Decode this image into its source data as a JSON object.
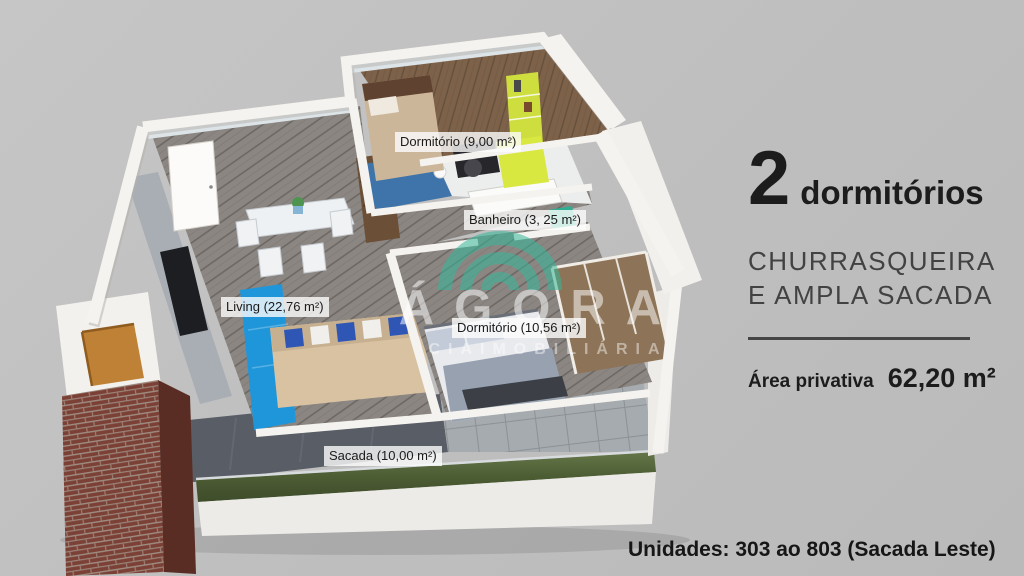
{
  "colors": {
    "background": "#bfbfbf",
    "watermark_teal": "#35b89a",
    "brick_red": "#7c4136",
    "glass_green": "#5a6b3c",
    "accent_blue": "#2096da",
    "accent_lime": "#cede3e"
  },
  "floorplan": {
    "rooms": [
      {
        "id": "dormitorio-1",
        "label": "Dormitório (9,00 m²)"
      },
      {
        "id": "banheiro",
        "label": "Banheiro (3, 25 m²)"
      },
      {
        "id": "living",
        "label": "Living (22,76 m²)"
      },
      {
        "id": "dormitorio-2",
        "label": "Dormitório (10,56 m²)"
      },
      {
        "id": "sacada",
        "label": "Sacada (10,00 m²)"
      }
    ],
    "watermark": {
      "brand": "ÁGORA",
      "subtitle": "CIAIMOBILIÁRIA",
      "logo": "triple-arc-logo"
    }
  },
  "info_panel": {
    "bedrooms_count": "2",
    "bedrooms_label": "dormitórios",
    "features_line1": "CHURRASQUEIRA",
    "features_line2": "E AMPLA SACADA",
    "area_label": "Área privativa",
    "area_value": "62,20 m²"
  },
  "footer": {
    "units_text": "Unidades: 303 ao 803 (Sacada Leste)"
  }
}
